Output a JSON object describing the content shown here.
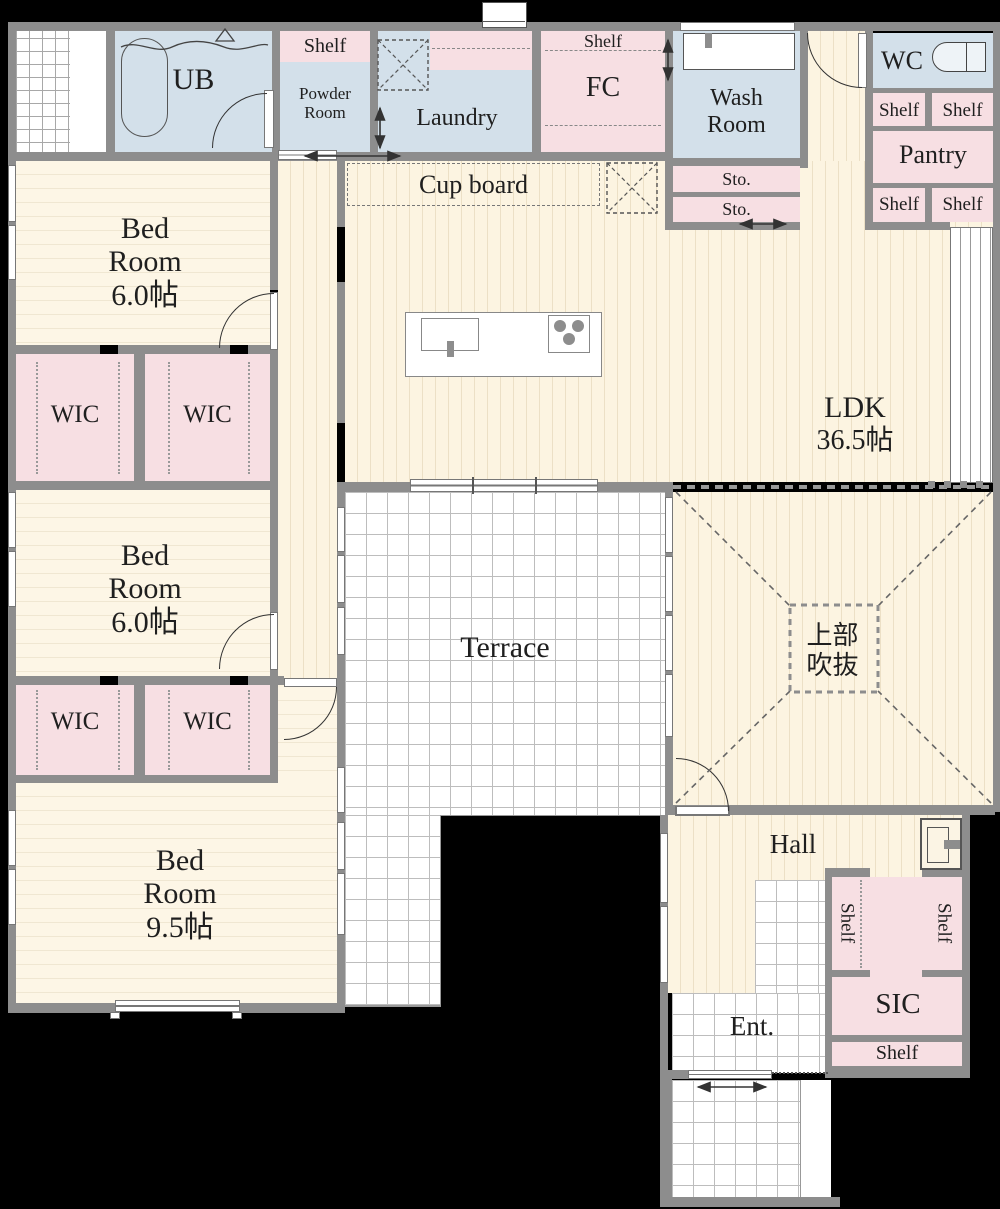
{
  "plan": {
    "rooms": {
      "ub": "UB",
      "powder": {
        "l1": "Powder",
        "l2": "Room"
      },
      "laundry": "Laundry",
      "fc": "FC",
      "wash": {
        "l1": "Wash",
        "l2": "Room"
      },
      "sto": "Sto.",
      "wc": "WC",
      "pantry": "Pantry",
      "shelf": "Shelf",
      "cupboard": "Cup board",
      "ldk": {
        "name": "LDK",
        "size": "36.5帖"
      },
      "bed1": {
        "l1": "Bed",
        "l2": "Room",
        "size": "6.0帖"
      },
      "bed2": {
        "l1": "Bed",
        "l2": "Room",
        "size": "6.0帖"
      },
      "bed3": {
        "l1": "Bed",
        "l2": "Room",
        "size": "9.5帖"
      },
      "wic": "WIC",
      "terrace": "Terrace",
      "void": {
        "l1": "上部",
        "l2": "吹抜"
      },
      "hall": "Hall",
      "ent": "Ent.",
      "sic": "SIC"
    },
    "colors": {
      "wall": "#8d8d8d",
      "room_blue": "#d3e0ea",
      "room_pink": "#f7dfe3",
      "floor_beige": "#fcf4e1",
      "tile_white": "#ffffff"
    }
  }
}
